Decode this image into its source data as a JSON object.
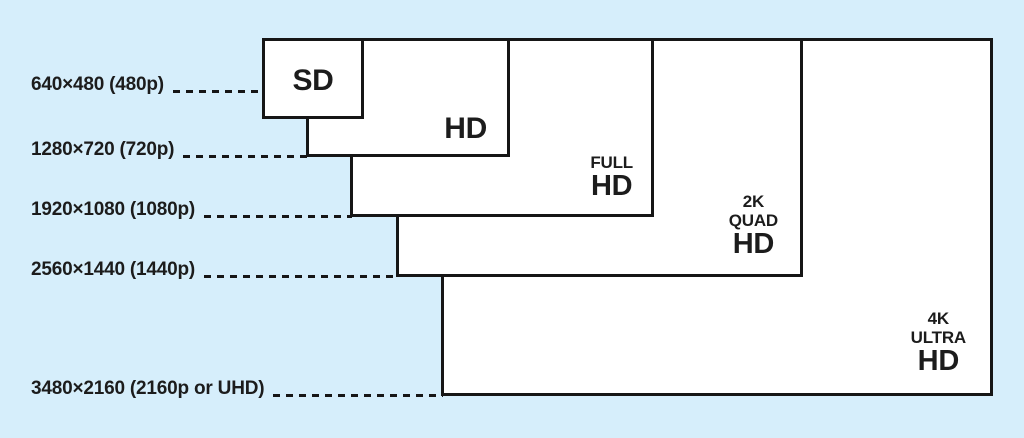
{
  "diagram": {
    "colors": {
      "background": "#d6eefb",
      "line": "#161616",
      "box_fill": "#ffffff",
      "text": "#1c1c1c"
    },
    "rows": [
      {
        "label": "640×480 (480p)"
      },
      {
        "label": "1280×720 (720p)"
      },
      {
        "label": "1920×1080 (1080p)"
      },
      {
        "label": "2560×1440 (1440p)"
      },
      {
        "label": "3480×2160 (2160p or UHD)"
      }
    ],
    "boxes": [
      {
        "id": "sd",
        "lines": [
          "SD"
        ]
      },
      {
        "id": "hd",
        "lines": [
          "HD"
        ]
      },
      {
        "id": "full-hd",
        "lines": [
          "FULL",
          "HD"
        ]
      },
      {
        "id": "quad-hd",
        "lines": [
          "2K",
          "QUAD",
          "HD"
        ]
      },
      {
        "id": "ultra-hd",
        "lines": [
          "4K",
          "ULTRA",
          "HD"
        ]
      }
    ]
  }
}
